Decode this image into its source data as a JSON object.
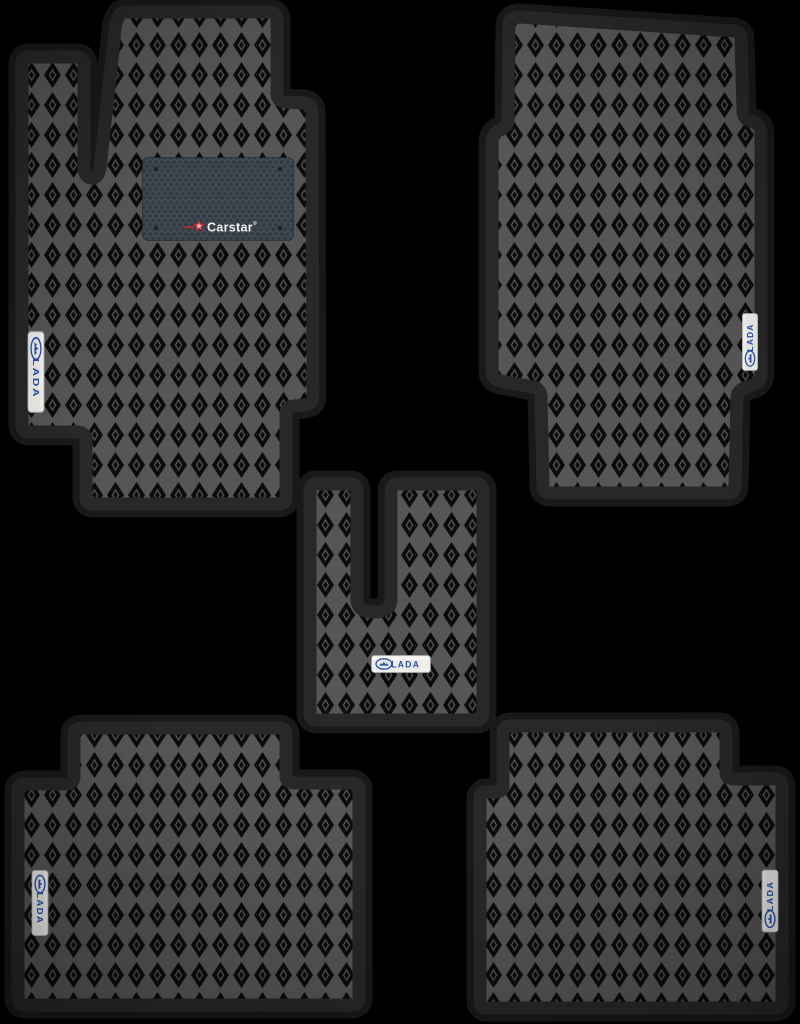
{
  "heel_pad": {
    "brand": "Carstar",
    "reg_mark": "®"
  },
  "mats": [
    {
      "name": "driver-front-left-mat",
      "badge_label": "LADA"
    },
    {
      "name": "passenger-front-right-mat",
      "badge_label": "LADA"
    },
    {
      "name": "center-tunnel-mat",
      "badge_label": "LADA"
    },
    {
      "name": "rear-left-mat",
      "badge_label": "LADA"
    },
    {
      "name": "rear-right-mat",
      "badge_label": "LADA"
    }
  ],
  "icons": {
    "lada_logo": "lada-oval-boat-logo",
    "carstar_star": "red-five-point-star"
  },
  "colors": {
    "background": "#000000",
    "edge_band": "#282828",
    "eva_lattice": "#565656",
    "eva_cell": "#0b0b0b",
    "heel_pad_bg": "#333a43",
    "badge_bg": "#eeeeeb",
    "lada_blue": "#2a4fae",
    "carstar_red": "#d8232a",
    "carstar_white": "#f2f2f2"
  }
}
